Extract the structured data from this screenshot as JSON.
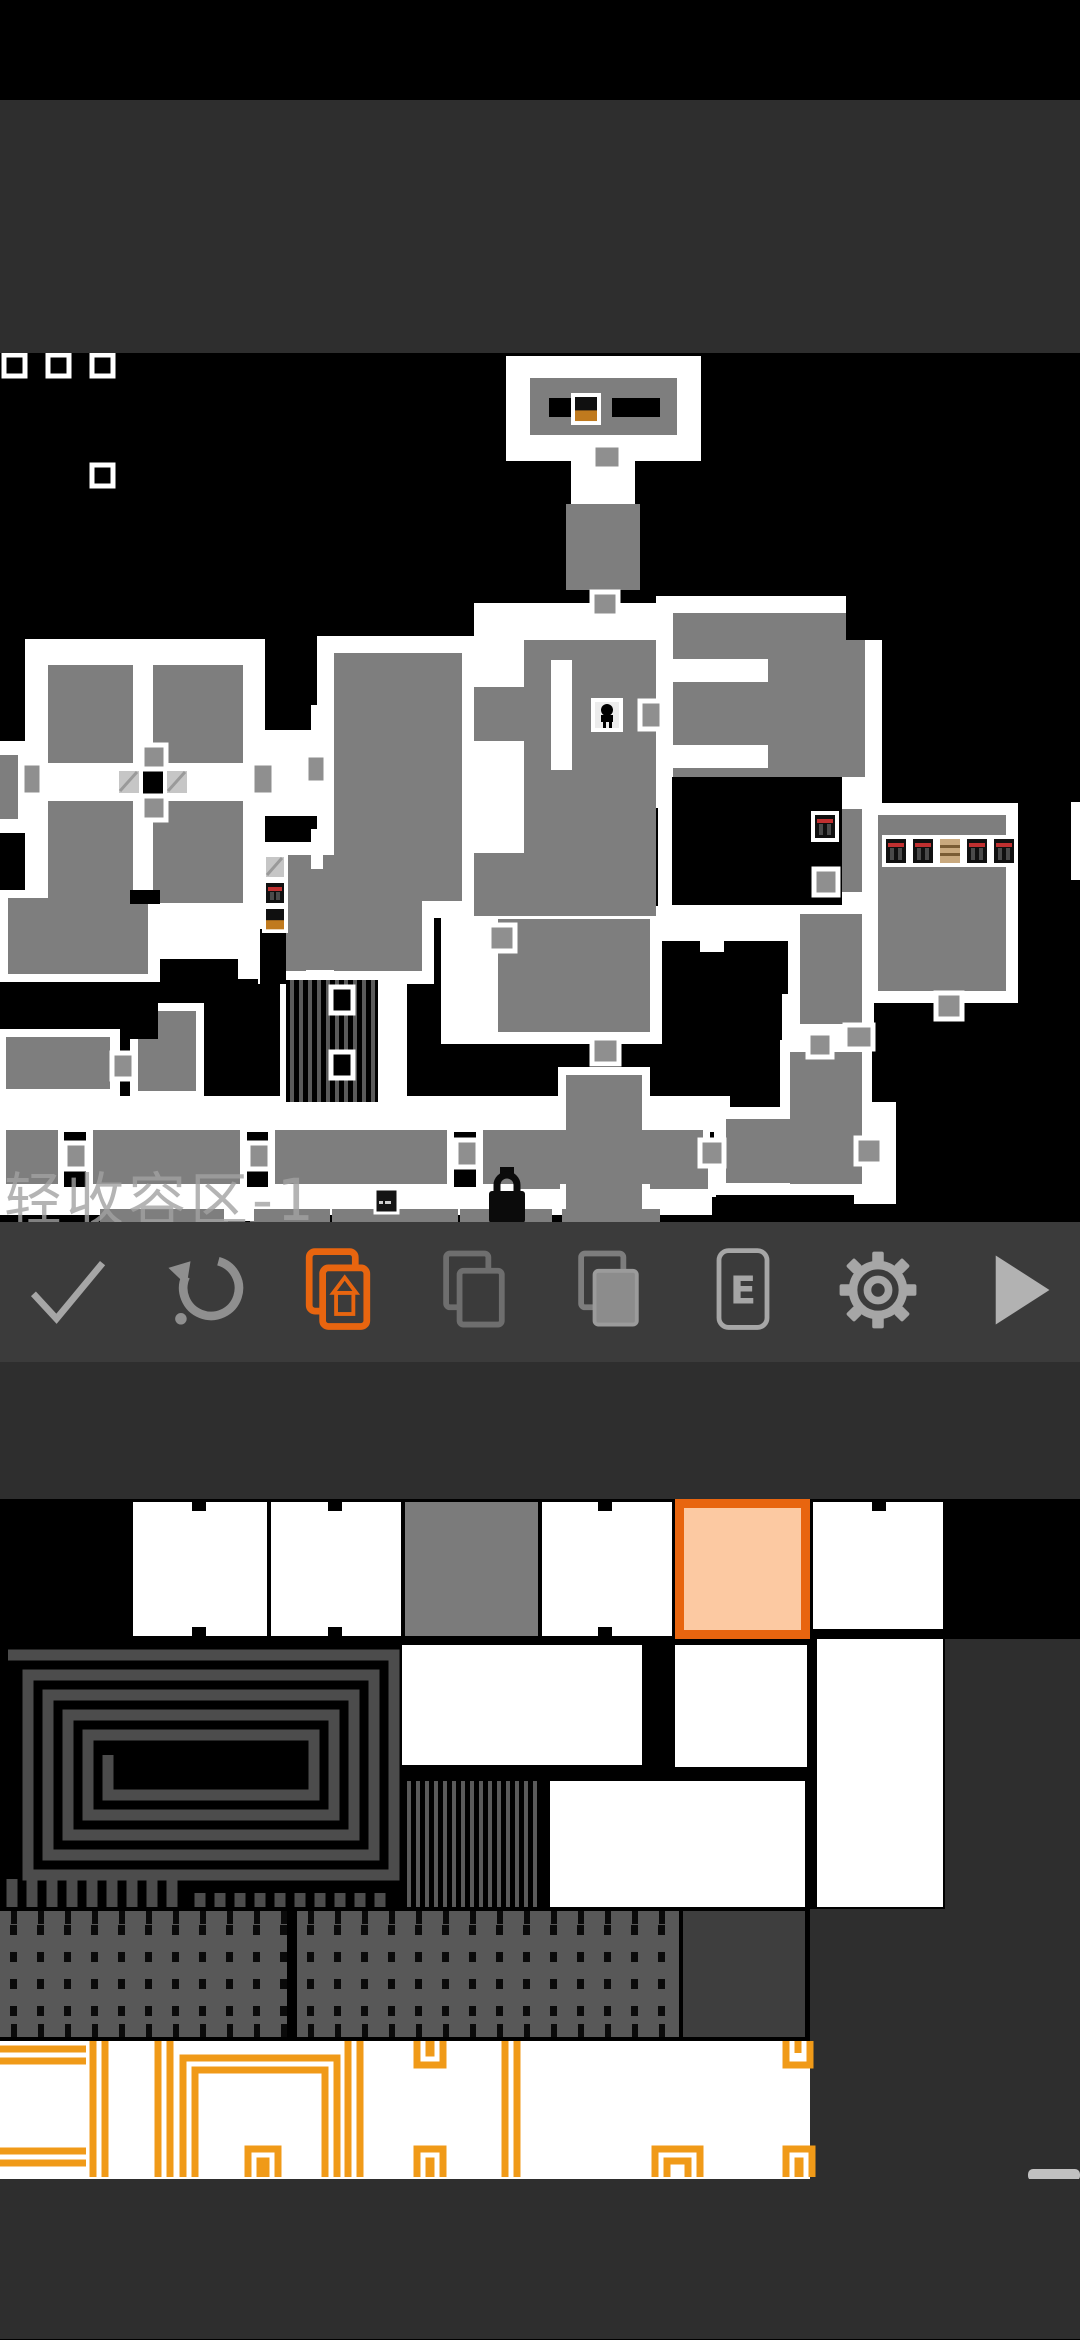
{
  "colors": {
    "accent": "#e8650f",
    "toolbar_bg": "#3b3b3b",
    "panel_bg": "#2e2e2e",
    "map_bg": "#000000",
    "room_gray": "#7e7e7e",
    "wall_white": "#ffffff",
    "door_gray": "#8f8f8f",
    "selected_fill": "#fcc9a2",
    "selected_border": "#e8650f",
    "outline_orange": "#f09a18",
    "spiral_gray": "#4c4c4c",
    "dots_bg": "#585858",
    "dark_tile": "#3e3e3e",
    "scroll_thumb": "#c0c0c0"
  },
  "toolbar": {
    "e_label": "E",
    "buttons": [
      {
        "name": "confirm-button",
        "icon": "check-icon",
        "active": false
      },
      {
        "name": "undo-button",
        "icon": "undo-icon",
        "active": false
      },
      {
        "name": "layer-draw-button",
        "icon": "layers-pencil-icon",
        "active": true
      },
      {
        "name": "duplicate-button",
        "icon": "pages-outline-icon",
        "active": false
      },
      {
        "name": "copy-button",
        "icon": "pages-filled-icon",
        "active": false
      },
      {
        "name": "events-button",
        "icon": "e-badge-icon",
        "active": false
      },
      {
        "name": "settings-button",
        "icon": "gear-icon",
        "active": false
      },
      {
        "name": "play-button",
        "icon": "play-icon",
        "active": false
      }
    ]
  },
  "map": {
    "zone_label": "轻收容区-1",
    "whites": [
      [
        506,
        357,
        195,
        105
      ],
      [
        571,
        459,
        64,
        48
      ],
      [
        571,
        617,
        64,
        46
      ],
      [
        474,
        604,
        212,
        37
      ],
      [
        317,
        637,
        162,
        282
      ],
      [
        479,
        604,
        46,
        315
      ],
      [
        25,
        640,
        240,
        290
      ],
      [
        0,
        742,
        26,
        92
      ],
      [
        263,
        731,
        56,
        86
      ],
      [
        656,
        597,
        226,
        212
      ],
      [
        658,
        800,
        192,
        117
      ],
      [
        656,
        907,
        226,
        35
      ],
      [
        843,
        800,
        37,
        110
      ],
      [
        788,
        798,
        86,
        107
      ],
      [
        788,
        903,
        86,
        134
      ],
      [
        866,
        804,
        152,
        200
      ],
      [
        486,
        908,
        176,
        137
      ],
      [
        441,
        905,
        50,
        140
      ],
      [
        258,
        843,
        176,
        142
      ],
      [
        238,
        846,
        28,
        134
      ],
      [
        0,
        891,
        160,
        92
      ],
      [
        150,
        916,
        92,
        44
      ],
      [
        280,
        975,
        103,
        134
      ],
      [
        377,
        975,
        30,
        134
      ],
      [
        0,
        1097,
        730,
        36
      ],
      [
        0,
        1030,
        120,
        68
      ],
      [
        130,
        1004,
        74,
        96
      ],
      [
        0,
        1188,
        712,
        28
      ],
      [
        558,
        1068,
        92,
        148
      ],
      [
        508,
        1142,
        208,
        56
      ],
      [
        780,
        1041,
        92,
        154
      ],
      [
        714,
        1108,
        158,
        88
      ],
      [
        854,
        1103,
        42,
        102
      ],
      [
        1071,
        803,
        9,
        78
      ],
      [
        0,
        1124,
        64,
        68
      ],
      [
        86,
        1124,
        161,
        68
      ],
      [
        268,
        1124,
        186,
        68
      ],
      [
        476,
        1124,
        234,
        68
      ],
      [
        782,
        995,
        90,
        50
      ]
    ],
    "grays": [
      [
        530,
        379,
        147,
        57
      ],
      [
        566,
        505,
        74,
        86
      ],
      [
        334,
        654,
        128,
        248
      ],
      [
        474,
        688,
        56,
        54
      ],
      [
        474,
        854,
        56,
        63
      ],
      [
        524,
        641,
        132,
        276
      ],
      [
        673,
        614,
        192,
        164
      ],
      [
        48,
        666,
        85,
        238
      ],
      [
        153,
        666,
        90,
        238
      ],
      [
        0,
        756,
        18,
        64
      ],
      [
        800,
        810,
        62,
        83
      ],
      [
        800,
        915,
        62,
        110
      ],
      [
        878,
        816,
        128,
        176
      ],
      [
        498,
        920,
        152,
        113
      ],
      [
        272,
        856,
        150,
        116
      ],
      [
        8,
        899,
        140,
        76
      ],
      [
        6,
        1038,
        104,
        52
      ],
      [
        138,
        1012,
        58,
        80
      ],
      [
        6,
        1131,
        52,
        54
      ],
      [
        93,
        1131,
        147,
        54
      ],
      [
        275,
        1131,
        172,
        54
      ],
      [
        483,
        1131,
        220,
        54
      ],
      [
        566,
        1076,
        76,
        140
      ],
      [
        516,
        1150,
        44,
        40
      ],
      [
        650,
        1150,
        58,
        40
      ],
      [
        790,
        1053,
        72,
        132
      ],
      [
        726,
        1120,
        134,
        64
      ],
      [
        100,
        1210,
        128,
        14
      ],
      [
        250,
        1210,
        80,
        14
      ],
      [
        332,
        1210,
        126,
        14
      ],
      [
        460,
        1210,
        92,
        14
      ],
      [
        562,
        1210,
        98,
        14
      ]
    ],
    "overlays": [
      [
        46,
        764,
        200,
        38
      ],
      [
        551,
        661,
        21,
        110
      ],
      [
        311,
        706,
        12,
        40
      ],
      [
        311,
        830,
        12,
        40
      ],
      [
        306,
        971,
        28,
        16
      ],
      [
        666,
        660,
        102,
        23
      ],
      [
        666,
        746,
        102,
        23
      ],
      [
        700,
        929,
        24,
        24
      ]
    ],
    "blacks": [
      [
        549,
        399,
        43,
        19
      ],
      [
        612,
        399,
        48,
        19
      ],
      [
        672,
        778,
        170,
        128
      ],
      [
        260,
        930,
        26,
        55
      ],
      [
        142,
        772,
        24,
        23
      ],
      [
        130,
        1004,
        28,
        36
      ],
      [
        846,
        597,
        36,
        44
      ],
      [
        130,
        891,
        30,
        14
      ]
    ],
    "bars": [
      {
        "x": 286,
        "y": 981,
        "w": 92,
        "h": 122
      }
    ],
    "doors": [
      [
        593,
        446,
        28,
        24
      ],
      [
        592,
        593,
        26,
        24
      ],
      [
        489,
        926,
        26,
        26
      ],
      [
        640,
        702,
        22,
        28
      ],
      [
        142,
        746,
        24,
        24
      ],
      [
        142,
        797,
        24,
        24
      ],
      [
        22,
        764,
        20,
        32
      ],
      [
        252,
        764,
        22,
        32
      ],
      [
        592,
        1039,
        27,
        26
      ],
      [
        845,
        1026,
        28,
        24
      ],
      [
        814,
        870,
        24,
        26
      ],
      [
        808,
        1034,
        24,
        24
      ],
      [
        936,
        994,
        26,
        26
      ],
      [
        112,
        1054,
        22,
        26
      ],
      [
        65,
        1144,
        22,
        26
      ],
      [
        248,
        1144,
        22,
        26
      ],
      [
        456,
        1141,
        22,
        27
      ],
      [
        700,
        1141,
        24,
        26
      ],
      [
        856,
        1139,
        26,
        26
      ],
      [
        306,
        756,
        20,
        28
      ]
    ],
    "void_markers": [
      [
        4,
        356,
        21,
        21
      ],
      [
        48,
        356,
        21,
        21
      ],
      [
        92,
        356,
        21,
        21
      ],
      [
        92,
        466,
        21,
        21
      ],
      [
        331,
        988,
        22,
        26
      ],
      [
        331,
        1053,
        22,
        26
      ]
    ],
    "items": [
      {
        "type": "split",
        "x": 573,
        "y": 396,
        "w": 26,
        "h": 28
      },
      {
        "type": "person",
        "x": 593,
        "y": 701,
        "w": 28,
        "h": 30
      },
      {
        "type": "glass",
        "x": 117,
        "y": 770,
        "w": 24,
        "h": 26
      },
      {
        "type": "glass",
        "x": 165,
        "y": 770,
        "w": 24,
        "h": 26
      },
      {
        "type": "glass",
        "x": 264,
        "y": 856,
        "w": 22,
        "h": 24
      },
      {
        "type": "red",
        "x": 264,
        "y": 882,
        "w": 22,
        "h": 24
      },
      {
        "type": "split",
        "x": 264,
        "y": 908,
        "w": 22,
        "h": 24
      },
      {
        "type": "red",
        "x": 813,
        "y": 814,
        "w": 24,
        "h": 27
      },
      {
        "type": "red",
        "x": 884,
        "y": 838,
        "w": 24,
        "h": 28
      },
      {
        "type": "red",
        "x": 911,
        "y": 838,
        "w": 24,
        "h": 28
      },
      {
        "type": "crate",
        "x": 938,
        "y": 838,
        "w": 24,
        "h": 28
      },
      {
        "type": "red",
        "x": 965,
        "y": 838,
        "w": 24,
        "h": 28
      },
      {
        "type": "red",
        "x": 992,
        "y": 838,
        "w": 24,
        "h": 28
      },
      {
        "type": "sign",
        "x": 375,
        "y": 1190,
        "w": 23,
        "h": 24
      },
      {
        "type": "whitetile",
        "x": 224,
        "y": 1204,
        "w": 30,
        "h": 18
      }
    ],
    "lock": {
      "x": 489,
      "y": 1168
    }
  },
  "palette": {
    "black_zones": [
      [
        0,
        1500,
        1080,
        140
      ],
      [
        0,
        1640,
        945,
        270
      ],
      [
        0,
        1910,
        810,
        132
      ]
    ],
    "white_zones": [
      [
        0,
        2042,
        810,
        138
      ]
    ],
    "row1_white_tiles": [
      [
        133,
        1503,
        134,
        134
      ],
      [
        271,
        1503,
        130,
        134
      ],
      [
        542,
        1503,
        130,
        134
      ],
      [
        813,
        1503,
        130,
        127
      ]
    ],
    "row1_gray_tiles": [
      [
        405,
        1503,
        133,
        134
      ]
    ],
    "notches": [
      [
        192,
        1503,
        14,
        9
      ],
      [
        192,
        1628,
        14,
        9
      ],
      [
        328,
        1503,
        14,
        9
      ],
      [
        328,
        1628,
        14,
        9
      ],
      [
        598,
        1503,
        14,
        9
      ],
      [
        598,
        1628,
        14,
        9
      ],
      [
        872,
        1503,
        14,
        9
      ]
    ],
    "selected_tile": {
      "x": 675,
      "y": 1500,
      "w": 135,
      "h": 140,
      "border": 9
    },
    "room_tiles": [
      [
        402,
        1646,
        240,
        120
      ],
      [
        550,
        1782,
        134,
        126
      ],
      [
        675,
        1646,
        132,
        122
      ],
      [
        675,
        1782,
        130,
        126
      ],
      [
        817,
        1640,
        126,
        268
      ]
    ],
    "bars_tiles": [
      [
        402,
        1782,
        136,
        126
      ]
    ],
    "spiral": {
      "x": 8,
      "y": 1656,
      "w": 386,
      "h": 220,
      "step": 20,
      "width": 11
    },
    "fringe": {
      "x1": 12,
      "x2": 190,
      "y": 1880,
      "h": 28,
      "step": 20
    },
    "dashes": {
      "x1": 200,
      "x2": 392,
      "y": 1894,
      "h": 14,
      "step": 20
    },
    "dot_tiles": [
      [
        0,
        1912,
        287,
        126
      ],
      [
        297,
        1912,
        382,
        126
      ]
    ],
    "dark_tiles": [
      [
        683,
        1912,
        122,
        126
      ]
    ],
    "orange_shapes": [
      {
        "type": "hpair",
        "x": 0,
        "x2": 86,
        "y": 2050
      },
      {
        "type": "hpair",
        "x": 0,
        "x2": 86,
        "y": 2152
      },
      {
        "type": "vpair",
        "x": 93,
        "y1": 2042,
        "y2": 2178
      },
      {
        "type": "vpair",
        "x": 158,
        "y1": 2042,
        "y2": 2178
      },
      {
        "type": "vpair",
        "x": 348,
        "y1": 2042,
        "y2": 2178
      },
      {
        "type": "vpair",
        "x": 505,
        "y1": 2042,
        "y2": 2178
      },
      {
        "type": "frame",
        "x": 183,
        "x2": 337,
        "y": 2059
      },
      {
        "type": "cap",
        "x": 248,
        "x2": 278,
        "y": 2150
      },
      {
        "type": "cap",
        "x": 417,
        "x2": 443,
        "y": 2150
      },
      {
        "type": "cup",
        "x": 417,
        "x2": 443,
        "y": 2066
      },
      {
        "type": "cup",
        "x": 786,
        "x2": 810,
        "y": 2066
      },
      {
        "type": "cap",
        "x": 655,
        "x2": 700,
        "y": 2150
      },
      {
        "type": "cap",
        "x": 786,
        "x2": 812,
        "y": 2150
      }
    ],
    "scroll_thumb": [
      1028,
      2170,
      52,
      12
    ]
  }
}
